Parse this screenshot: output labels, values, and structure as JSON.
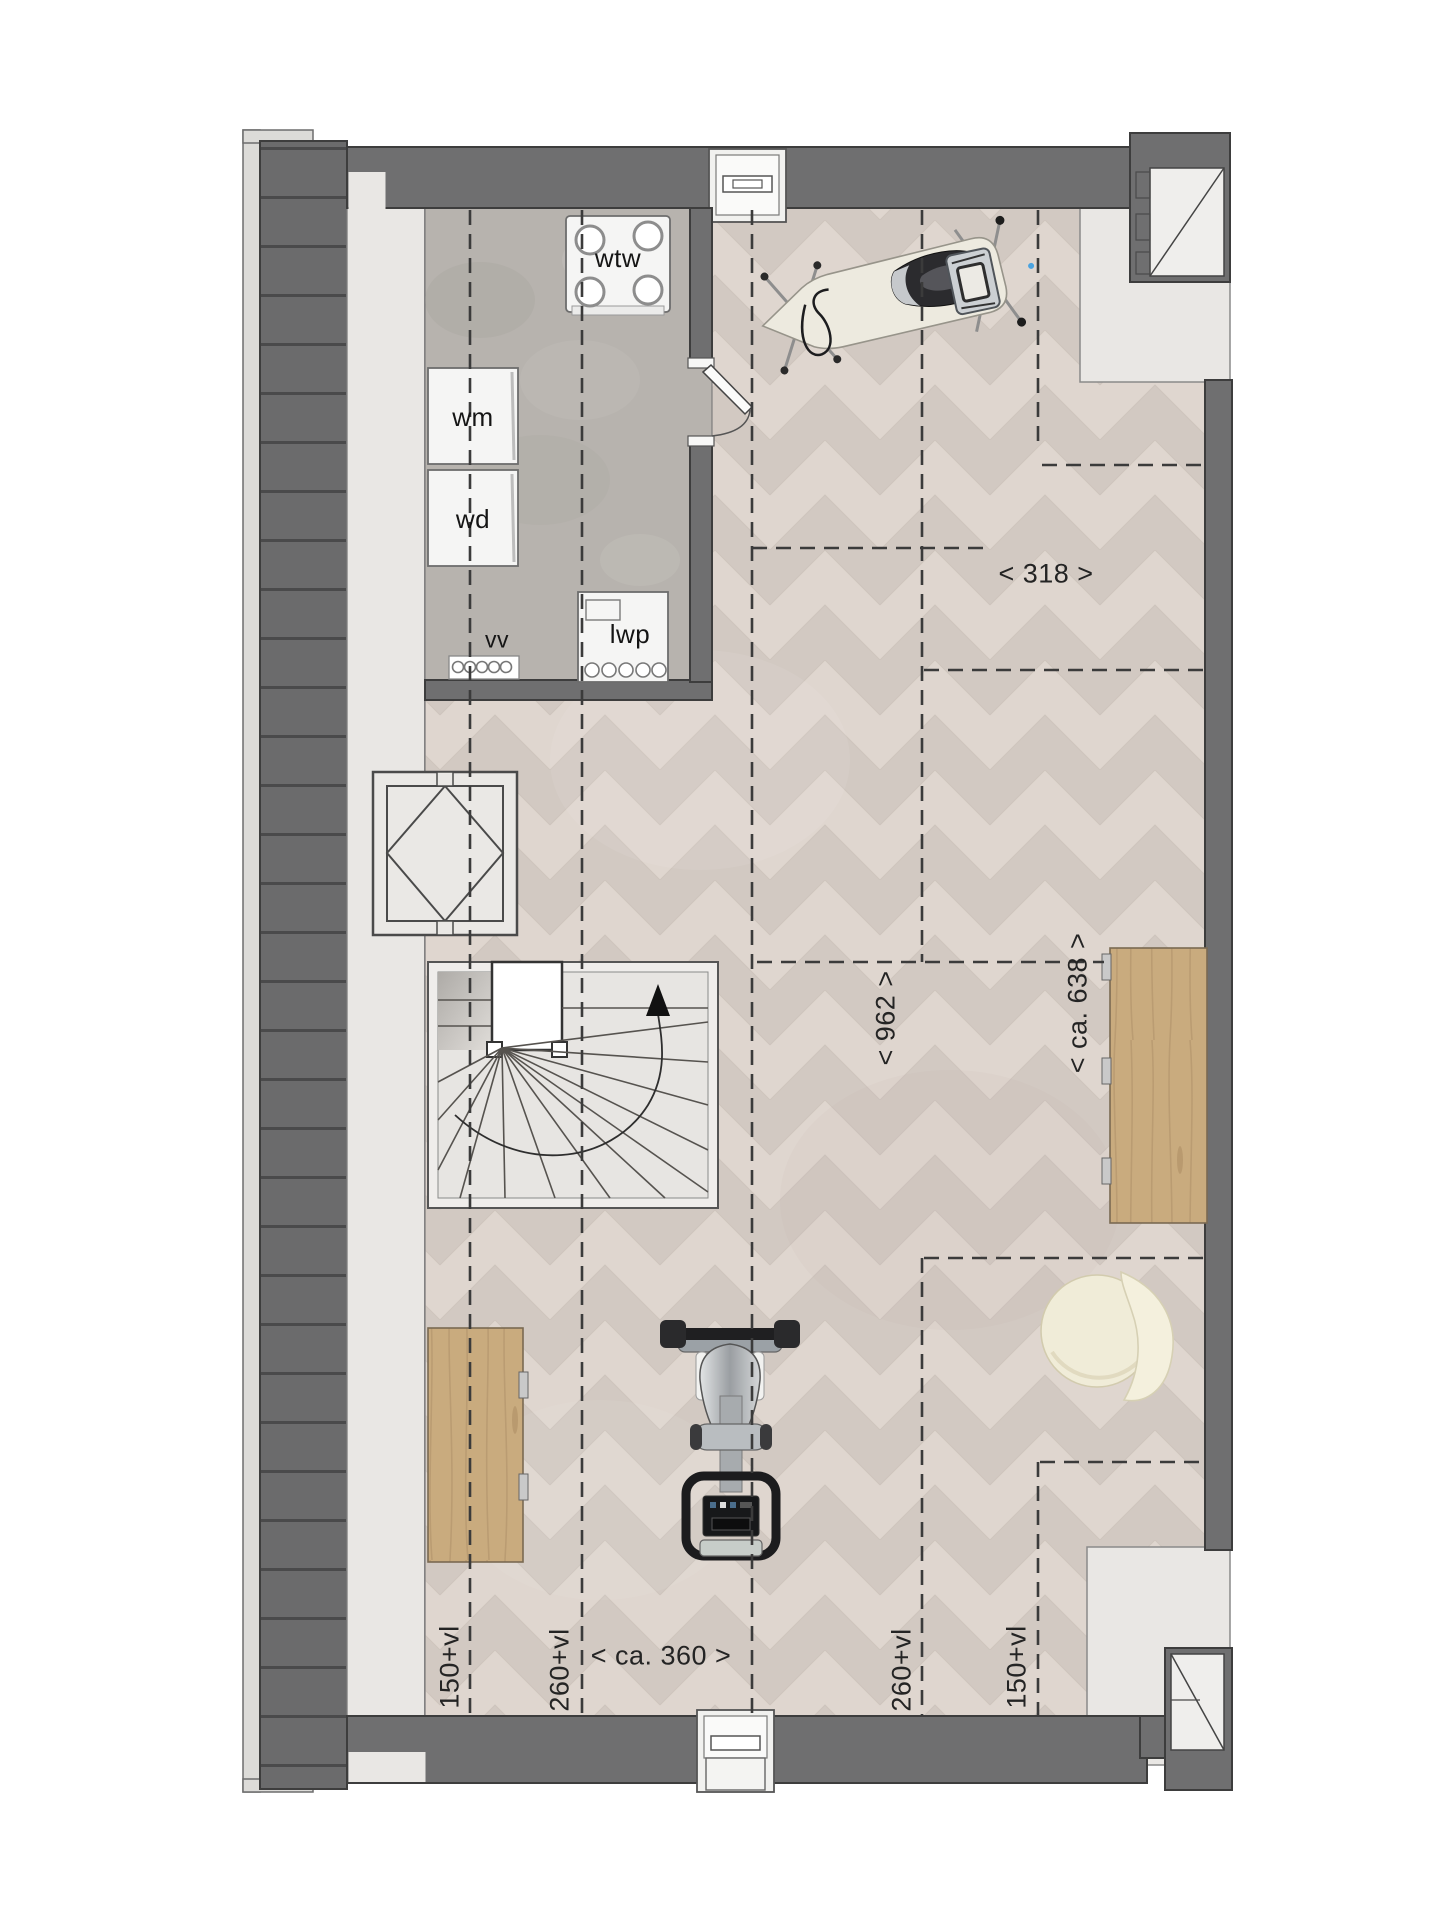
{
  "document": {
    "type": "residential floor plan",
    "floor": "attic / loft level",
    "style": "top-down architectural render"
  },
  "appliances": {
    "wtw": "wtw",
    "wm": "wm",
    "wd": "wd",
    "vv": "vv",
    "lwp": "lwp"
  },
  "dimensions": {
    "width_zone_right": "< 318 >",
    "length_main": "< 962 >",
    "length_right": "< ca. 638 >",
    "width_center": "< ca. 360 >",
    "headroom_150_left": "150+vl",
    "headroom_260_left": "260+vl",
    "headroom_260_right": "260+vl",
    "headroom_150_right": "150+vl"
  },
  "furniture": [
    "ironing board with iron",
    "iron rest stool",
    "fold-down desk right",
    "fold-down bench left",
    "beanbag pouf",
    "exercise machine",
    "winder staircase",
    "roof shaft with diamond marking"
  ],
  "colors": {
    "wall": "#6f6f70",
    "roof": "#6b6b6c",
    "concrete": "#b7b3ae",
    "parquet-base": "#d8cfc9",
    "parquet-light": "#e1d9d1",
    "parquet-dark": "#cfc6bf",
    "wood": "#c9ab7e",
    "wood-grain": "#b2946b",
    "cream": "#f0ecd8",
    "dash": "#3b3b3b",
    "void": "#e9e7e4"
  }
}
